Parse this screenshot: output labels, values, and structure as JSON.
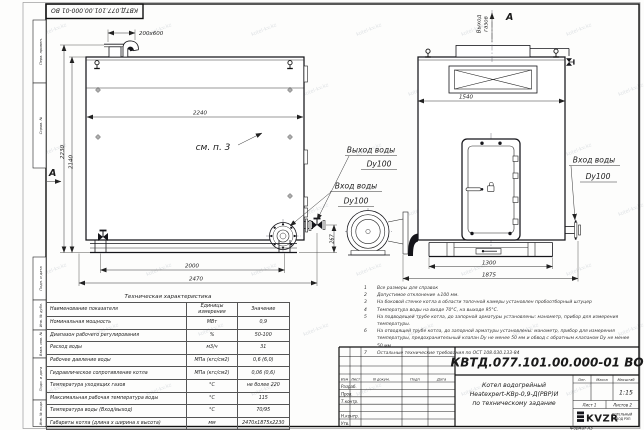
{
  "watermark": {
    "text": "kotel-kv.kz"
  },
  "doc": {
    "number": "КВТД.077.101.00.000-01 ВО",
    "format_label": "Формат А3"
  },
  "frame": {
    "stamps": {
      "perv_primen": "Перв. примен.",
      "sprav_no": "Справ. №",
      "podp_data_1": "Подп. и дата",
      "inv_dubl": "Инв. № дубл.",
      "vzam_inv": "Взам. инв. №",
      "podp_data_2": "Подп. и дата",
      "inv_podl": "Инв. № подл."
    }
  },
  "front_view": {
    "section_label": "А",
    "callout": "см. п. 3",
    "dims": {
      "flue_opening": "200x600",
      "width_top": "2240",
      "height_total": "2230",
      "height_body": "2140",
      "base": "2000",
      "length_total": "2470",
      "pipe_height": "267"
    },
    "labels": {
      "water_out_1": "Выход воды",
      "water_out_2": "Dy100",
      "water_in_1": "Вход воды",
      "water_in_2": "Dy100"
    }
  },
  "side_view": {
    "view_label": "А",
    "gas_out_1": "Выход",
    "gas_out_2": "газов",
    "dims": {
      "width": "1540",
      "base": "1300",
      "width_total": "1875"
    },
    "labels": {
      "water_in_1": "Вход воды",
      "water_in_2": "Dy100"
    }
  },
  "notes": [
    {
      "n": "1",
      "text": "Все размеры для справок"
    },
    {
      "n": "2",
      "text": "Допустимое отклонение ±100 мм."
    },
    {
      "n": "3",
      "text": "На боковой стенке котла в области топочной камеры установлен пробоотборный штуцер"
    },
    {
      "n": "4",
      "text": "Температура воды на входе 70°С, на выходе 95°С."
    },
    {
      "n": "5",
      "text": "На подводящей трубе котла, до запорной арматуры установлены: манометр, прибор для измерения температуры."
    },
    {
      "n": "6",
      "text": "На отводящей трубе котла, до запорной арматуры установлены: манометр, прибор для измерения температуры, предохранительный клапан Dу не менее 50 мм и обвод с обратным клапаном Dу не менее 50 мм."
    },
    {
      "n": "7",
      "text": "Остальные технические требования по ОСТ 108.030.133-84"
    }
  ],
  "table": {
    "title": "Техническая характеристика",
    "headers": {
      "name": "Наименование показателя",
      "units_1": "Единицы",
      "units_2": "измерения",
      "value": "Значение"
    },
    "rows": [
      {
        "name": "Номинальная мощность",
        "units": "МВт",
        "value": "0,9"
      },
      {
        "name": "Диапазон рабочего регулирования",
        "units": "%",
        "value": "50-100"
      },
      {
        "name": "Расход воды",
        "units": "м3/ч",
        "value": "31"
      },
      {
        "name": "Рабочее давление воды",
        "units": "МПа (кгс/см2)",
        "value": "0,6 (6,0)"
      },
      {
        "name": "Гидравлическое сопротивление котла",
        "units": "МПа (кгс/см2)",
        "value": "0,06 (0,6)"
      },
      {
        "name": "Температура уходящих газов",
        "units": "°С",
        "value": "не более 220"
      },
      {
        "name": "Максимальная рабочая температура воды",
        "units": "°С",
        "value": "115"
      },
      {
        "name": "Температура воды (Вход/выход)",
        "units": "°С",
        "value": "70/95"
      },
      {
        "name": "Габариты котла (длина x ширина x высота)",
        "units": "мм",
        "value": "2470x1875x2230"
      }
    ]
  },
  "title_block": {
    "doc_number": "КВТД.077.101.00.000-01 ВО",
    "title_1": "Котел водогрейный",
    "title_2": "Heatexpert-КВр-0,9-Д(РВР)И",
    "title_3": "по техническому задание",
    "cols": {
      "izm": "Изм",
      "list": "Лист",
      "n_dokum": "N докум.",
      "podp": "Подп",
      "data": "Дата"
    },
    "rows": {
      "razrab": "Разраб.",
      "prov": "Пров.",
      "t_kontr": "Т.контр.",
      "n_kontr": "Н.контр.",
      "utv": "Утв."
    },
    "right": {
      "lit": "Лит.",
      "massa": "Масса",
      "masshtab": "Масштаб",
      "scale": "1:15",
      "sheet": "Лист 1",
      "sheets": "Листов 2"
    },
    "logo": {
      "name": "KVZR",
      "sub_1": "КОТЕЛЬНЫЙ",
      "sub_2": "ЗАВОД РЭП"
    }
  }
}
